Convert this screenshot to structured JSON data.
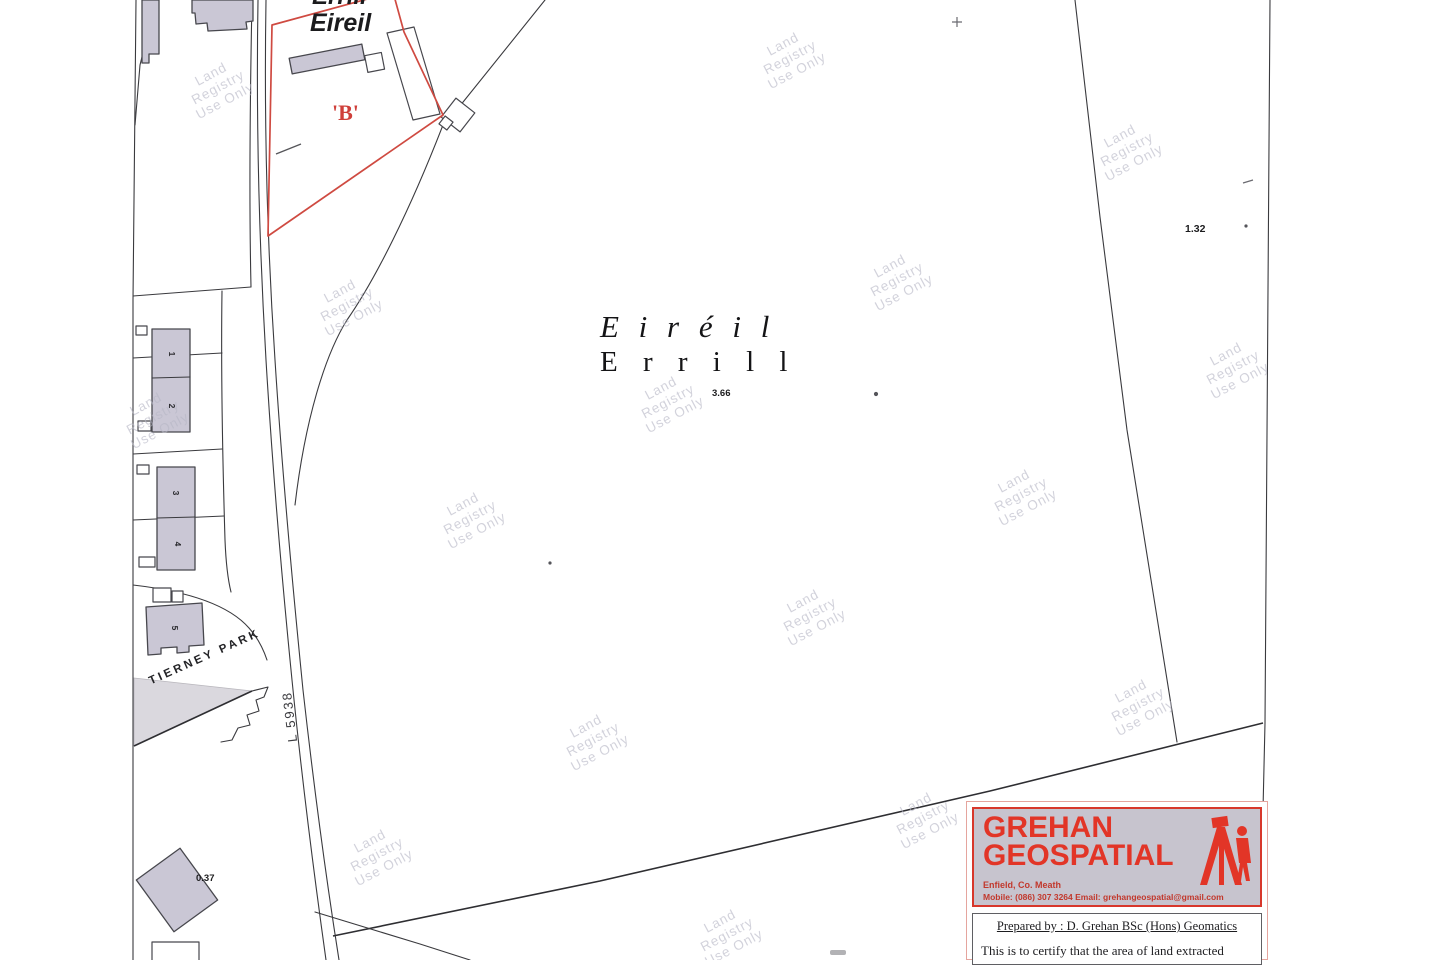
{
  "map": {
    "watermark": {
      "lines": [
        "Land",
        "Registry",
        "Use Only"
      ],
      "positions": [
        [
          213,
          78
        ],
        [
          785,
          48
        ],
        [
          1122,
          140
        ],
        [
          342,
          295
        ],
        [
          892,
          270
        ],
        [
          1228,
          358
        ],
        [
          148,
          408
        ],
        [
          465,
          508
        ],
        [
          663,
          392
        ],
        [
          1016,
          485
        ],
        [
          805,
          605
        ],
        [
          1133,
          695
        ],
        [
          588,
          730
        ],
        [
          372,
          845
        ],
        [
          918,
          808
        ],
        [
          722,
          925
        ]
      ]
    },
    "labels": {
      "top_irish_partial": "Errill",
      "top_irish": "Eireil",
      "parcel_b": "'B'",
      "townland_irish": "E i r é i l",
      "townland_english": "E r r i l l",
      "area_center": "3.66",
      "area_northeast": "1.32",
      "area_southwest": "0.37",
      "street_name": "TIERNEY PARK",
      "road_ref": "L 5938",
      "house_numbers": [
        "1",
        "2",
        "3",
        "4",
        "5"
      ]
    },
    "colors": {
      "parcel_outline_red": "#cf4a41",
      "building_fill": "#cac7d5",
      "boundary_line": "#3a3a3e",
      "watermark_gray": "#b7b7c6"
    }
  },
  "surveyor_box": {
    "name_line1": "GREHAN",
    "name_line2": "GEOSPATIAL",
    "address": "Enfield, Co. Meath",
    "contact": "Mobile: (086) 307 3264    Email: grehangeospatial@gmail.com",
    "prepared_by": "Prepared by : D. Grehan BSc (Hons) Geomatics",
    "certify_text": "This is to certify that the area of land extracted",
    "brand_red": "#e23527"
  }
}
